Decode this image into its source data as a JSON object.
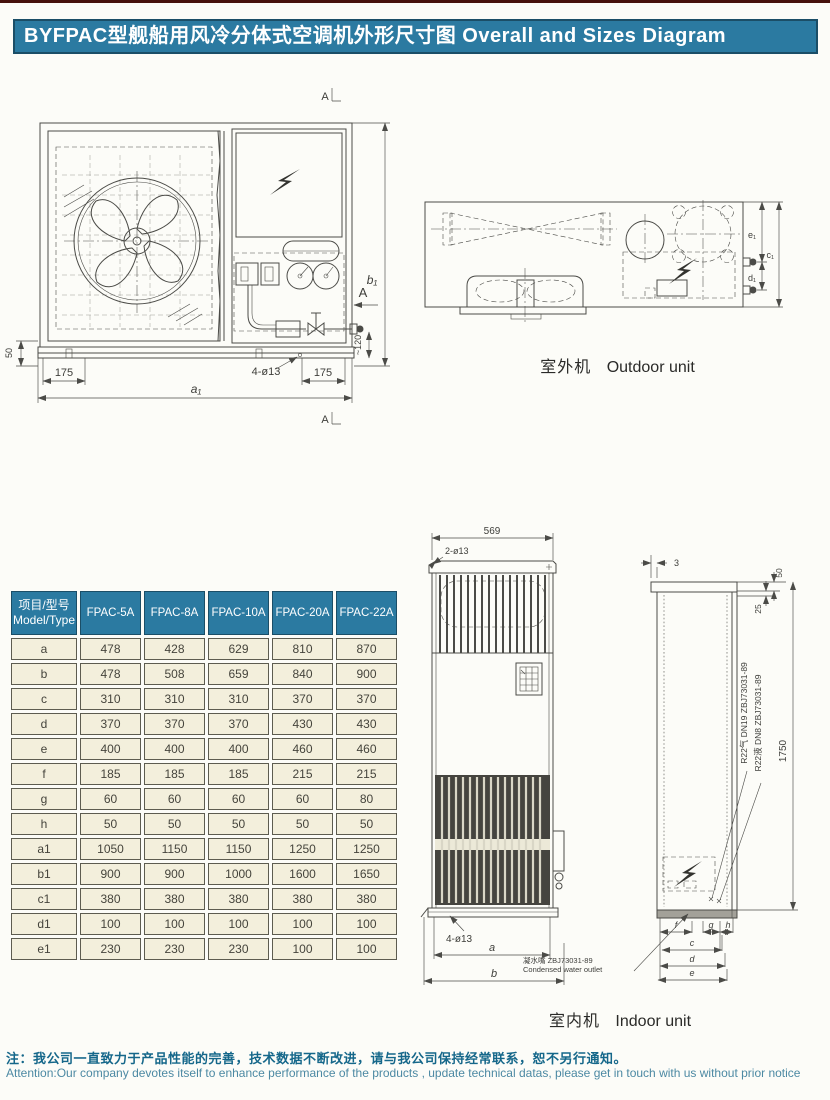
{
  "page": {
    "title": "BYFPAC型舰船用风冷分体式空调机外形尺寸图 Overall and Sizes Diagram",
    "colors": {
      "accent_teal": "#2b7aa1",
      "table_cell_bg": "#f3efdc",
      "top_rule_maroon": "#46120d",
      "drawing_line": "#4b4b47",
      "note_zh": "#15678a",
      "note_en": "#4c89a3"
    }
  },
  "outdoor": {
    "caption_zh": "室外机",
    "caption_en": "Outdoor unit",
    "front": {
      "dim_50": "50",
      "dim_175_left": "175",
      "dim_holes": "4-ø13",
      "dim_175_right": "175",
      "dim_a1": "a₁",
      "dim_b1": "b₁",
      "dim_120": "~120",
      "section_mark": "A"
    },
    "top": {
      "dim_e1": "e₁",
      "dim_d1": "d₁",
      "dim_c1": "c₁"
    }
  },
  "indoor": {
    "caption_zh": "室内机",
    "caption_en": "Indoor unit",
    "front": {
      "dim_569": "569",
      "dim_top_holes": "2-ø13",
      "dim_bottom_holes": "4-ø13",
      "dim_a": "a",
      "dim_b": "b"
    },
    "side": {
      "dim_3": "3",
      "dim_50": "50",
      "dim_25": "25",
      "dim_1750": "1750",
      "dim_f": "f",
      "dim_g": "g",
      "dim_h": "h",
      "dim_c": "c",
      "dim_d": "d",
      "dim_e": "e",
      "pipe_gas": "R22气 DN19 ZBJ73031-89",
      "pipe_liquid": "R22液 DN8 ZBJ73031-89"
    },
    "condensate_zh": "凝水嘴 ZBJ73031-89",
    "condensate_en": "Condensed water outlet"
  },
  "table": {
    "header": {
      "item_zh": "项目/型号",
      "item_en": "Model/Type",
      "models": [
        "FPAC-5A",
        "FPAC-8A",
        "FPAC-10A",
        "FPAC-20A",
        "FPAC-22A"
      ]
    },
    "rows": [
      {
        "label": "a",
        "values": [
          "478",
          "428",
          "629",
          "810",
          "870"
        ]
      },
      {
        "label": "b",
        "values": [
          "478",
          "508",
          "659",
          "840",
          "900"
        ]
      },
      {
        "label": "c",
        "values": [
          "310",
          "310",
          "310",
          "370",
          "370"
        ]
      },
      {
        "label": "d",
        "values": [
          "370",
          "370",
          "370",
          "430",
          "430"
        ]
      },
      {
        "label": "e",
        "values": [
          "400",
          "400",
          "400",
          "460",
          "460"
        ]
      },
      {
        "label": "f",
        "values": [
          "185",
          "185",
          "185",
          "215",
          "215"
        ]
      },
      {
        "label": "g",
        "values": [
          "60",
          "60",
          "60",
          "60",
          "80"
        ]
      },
      {
        "label": "h",
        "values": [
          "50",
          "50",
          "50",
          "50",
          "50"
        ]
      },
      {
        "label": "a1",
        "values": [
          "1050",
          "1150",
          "1150",
          "1250",
          "1250"
        ]
      },
      {
        "label": "b1",
        "values": [
          "900",
          "900",
          "1000",
          "1600",
          "1650"
        ]
      },
      {
        "label": "c1",
        "values": [
          "380",
          "380",
          "380",
          "380",
          "380"
        ]
      },
      {
        "label": "d1",
        "values": [
          "100",
          "100",
          "100",
          "100",
          "100"
        ]
      },
      {
        "label": "e1",
        "values": [
          "230",
          "230",
          "230",
          "100",
          "100"
        ]
      }
    ]
  },
  "note": {
    "zh": "注：我公司一直致力于产品性能的完善，技术数据不断改进，请与我公司保持经常联系，恕不另行通知。",
    "en": "Attention:Our company devotes itself to enhance performance of the products , update technical datas, please get in touch with us without prior notice"
  }
}
